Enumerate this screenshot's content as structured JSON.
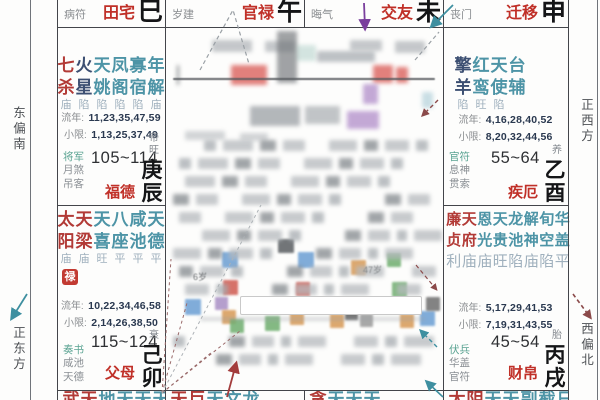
{
  "labels": {
    "liunian": "流年:",
    "xiaoxian": "小限:"
  },
  "directions": {
    "east_south": "东偏南",
    "east": "正东方",
    "west": "正西方",
    "west_north": "西偏北"
  },
  "top_row": [
    {
      "tag": "病符",
      "palace": "田宅",
      "branch": "巳"
    },
    {
      "tag": "岁建",
      "palace": "官禄",
      "branch": "午"
    },
    {
      "tag": "晦气",
      "palace": "交友",
      "branch": "未"
    },
    {
      "tag": "丧门",
      "palace": "迁移",
      "branch": "申"
    }
  ],
  "bottom_row": [
    {
      "text": "武天地天天天蜚",
      "red_count": 2
    },
    {
      "text": "天巨天文龙",
      "red_count": 2
    },
    {
      "text": "贪天天天",
      "red_count": 1
    },
    {
      "text": "太阴天天副截日",
      "red_count": 2
    }
  ],
  "palaces": {
    "left_mid": {
      "stars": [
        {
          "name": "七杀",
          "type": "major",
          "bright": "庙"
        },
        {
          "name": "火星",
          "type": "sha",
          "bright": "陷"
        },
        {
          "name": "天姚",
          "type": "minor",
          "bright": "陷"
        },
        {
          "name": "凤阁",
          "type": "minor",
          "bright": "陷"
        },
        {
          "name": "寡宿",
          "type": "minor",
          "bright": "陷"
        },
        {
          "name": "年解",
          "type": "minor",
          "bright": "庙"
        }
      ],
      "liunian": "11,23,35,47,59",
      "xiaoxian": "1,13,25,37,49",
      "minor_stars": [
        "将军",
        "月煞",
        "吊客"
      ],
      "age_range": "105~114",
      "palace_name": "福德",
      "stage": "帝旺",
      "stem_branch": "庚辰"
    },
    "left_bottom": {
      "stars": [
        {
          "name": "太阳",
          "type": "major",
          "bright": "庙"
        },
        {
          "name": "天梁",
          "type": "major",
          "bright": "庙"
        },
        {
          "name": "天喜",
          "type": "minor",
          "bright": "旺"
        },
        {
          "name": "八座",
          "type": "minor",
          "bright": "平"
        },
        {
          "name": "咸池",
          "type": "minor",
          "bright": "平"
        },
        {
          "name": "天德",
          "type": "minor",
          "bright": "平"
        }
      ],
      "hua": "禄",
      "liunian": "10,22,34,46,58",
      "xiaoxian": "2,14,26,38,50",
      "minor_stars": [
        "奏书",
        "咸池",
        "天德"
      ],
      "age_range": "115~124",
      "palace_name": "父母",
      "stage": "衰",
      "stem_branch": "己卯"
    },
    "right_mid": {
      "stars": [
        {
          "name": "擎羊",
          "type": "sha",
          "bright": "陷"
        },
        {
          "name": "红鸾",
          "type": "minor",
          "bright": "旺"
        },
        {
          "name": "天使",
          "type": "minor",
          "bright": "陷"
        },
        {
          "name": "台辅",
          "type": "minor",
          "bright": ""
        }
      ],
      "liunian": "4,16,28,40,52",
      "xiaoxian": "8,20,32,44,56",
      "minor_stars": [
        "官符",
        "息神",
        "贯索"
      ],
      "age_range": "55~64",
      "palace_name": "疾厄",
      "stage": "养",
      "stem_branch": "乙酉"
    },
    "right_bottom": {
      "stars": [
        {
          "name": "廉贞",
          "type": "major",
          "bright": "利"
        },
        {
          "name": "天府",
          "type": "major",
          "bright": "庙"
        },
        {
          "name": "恩光",
          "type": "minor",
          "bright": "庙"
        },
        {
          "name": "天贵",
          "type": "minor",
          "bright": "旺"
        },
        {
          "name": "龙池",
          "type": "minor",
          "bright": "陷"
        },
        {
          "name": "解神",
          "type": "minor",
          "bright": "庙"
        },
        {
          "name": "旬空",
          "type": "minor",
          "bright": "陷"
        },
        {
          "name": "华盖",
          "type": "minor",
          "bright": "平"
        }
      ],
      "liunian": "5,17,29,41,53",
      "xiaoxian": "7,19,31,43,55",
      "minor_stars": [
        "伏兵",
        "华盖",
        "官符"
      ],
      "age_range": "45~54",
      "palace_name": "财帛",
      "stage": "胎",
      "stem_branch": "丙戌"
    }
  },
  "center": {
    "age_note_small": "6岁",
    "age_note_large": "47岁"
  },
  "colors": {
    "major_star": "#b23a36",
    "sha_star": "#3c4f72",
    "minor_star": "#4d94a6",
    "palace_name": "#c03028",
    "hua_lu_bg": "#c23a32",
    "arrow_teal": "#3e8fa0",
    "arrow_purple": "#7a3f9d",
    "arrow_red": "#a33c3c"
  }
}
